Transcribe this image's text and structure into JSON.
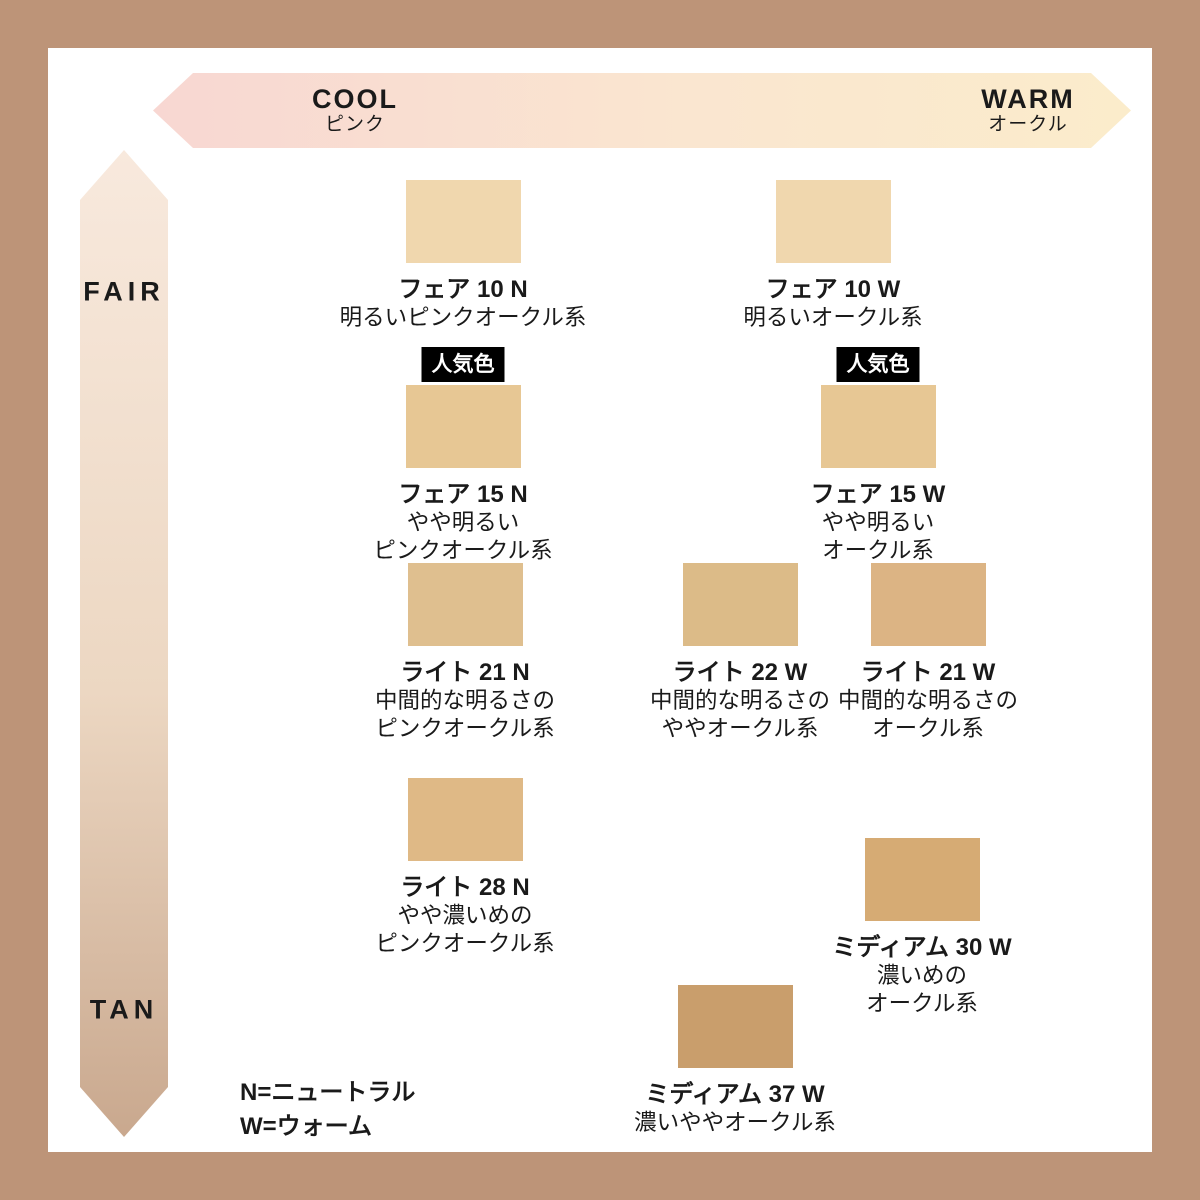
{
  "frame_color": "#bd9478",
  "axes": {
    "horizontal": {
      "left_label": "COOL",
      "left_sublabel": "ピンク",
      "right_label": "WARM",
      "right_sublabel": "オークル",
      "gradient_left": "#f8d7d2",
      "gradient_mid": "#fae6d0",
      "gradient_right": "#fbeccb"
    },
    "vertical": {
      "top_label": "FAIR",
      "bottom_label": "TAN",
      "gradient_top": "#f8e9dd",
      "gradient_mid": "#ecd7c2",
      "gradient_bottom": "#c9a88e"
    }
  },
  "badge": {
    "label": "人気色",
    "bg": "#000000",
    "text_color": "#ffffff"
  },
  "legend": {
    "line1": "N=ニュートラル",
    "line2": "W=ウォーム"
  },
  "shades": [
    {
      "name": "フェア 10 N",
      "desc_lines": [
        "明るいピンクオークル系"
      ],
      "color": "#f0d7ae",
      "popular": false,
      "cx": 463,
      "top": 180
    },
    {
      "name": "フェア 10 W",
      "desc_lines": [
        "明るいオークル系"
      ],
      "color": "#f0d7ae",
      "popular": false,
      "cx": 833,
      "top": 180
    },
    {
      "name": "フェア 15 N",
      "desc_lines": [
        "やや明るい",
        "ピンクオークル系"
      ],
      "color": "#e7c794",
      "popular": true,
      "cx": 463,
      "top": 385
    },
    {
      "name": "フェア 15 W",
      "desc_lines": [
        "やや明るい",
        "オークル系"
      ],
      "color": "#e7c794",
      "popular": true,
      "cx": 878,
      "top": 385
    },
    {
      "name": "ライト 21 N",
      "desc_lines": [
        "中間的な明るさの",
        "ピンクオークル系"
      ],
      "color": "#dfbf8f",
      "popular": false,
      "cx": 465,
      "top": 563
    },
    {
      "name": "ライト 22 W",
      "desc_lines": [
        "中間的な明るさの",
        "ややオークル系"
      ],
      "color": "#dcbb88",
      "popular": false,
      "cx": 740,
      "top": 563
    },
    {
      "name": "ライト 21 W",
      "desc_lines": [
        "中間的な明るさの",
        "オークル系"
      ],
      "color": "#dcb484",
      "popular": false,
      "cx": 928,
      "top": 563
    },
    {
      "name": "ライト 28 N",
      "desc_lines": [
        "やや濃いめの",
        "ピンクオークル系"
      ],
      "color": "#dfb986",
      "popular": false,
      "cx": 465,
      "top": 778
    },
    {
      "name": "ミディアム 30 W",
      "desc_lines": [
        "濃いめの",
        "オークル系"
      ],
      "color": "#d6ab74",
      "popular": false,
      "cx": 922,
      "top": 838
    },
    {
      "name": "ミディアム 37 W",
      "desc_lines": [
        "濃いややオークル系"
      ],
      "color": "#c99e6c",
      "popular": false,
      "cx": 735,
      "top": 985
    }
  ]
}
